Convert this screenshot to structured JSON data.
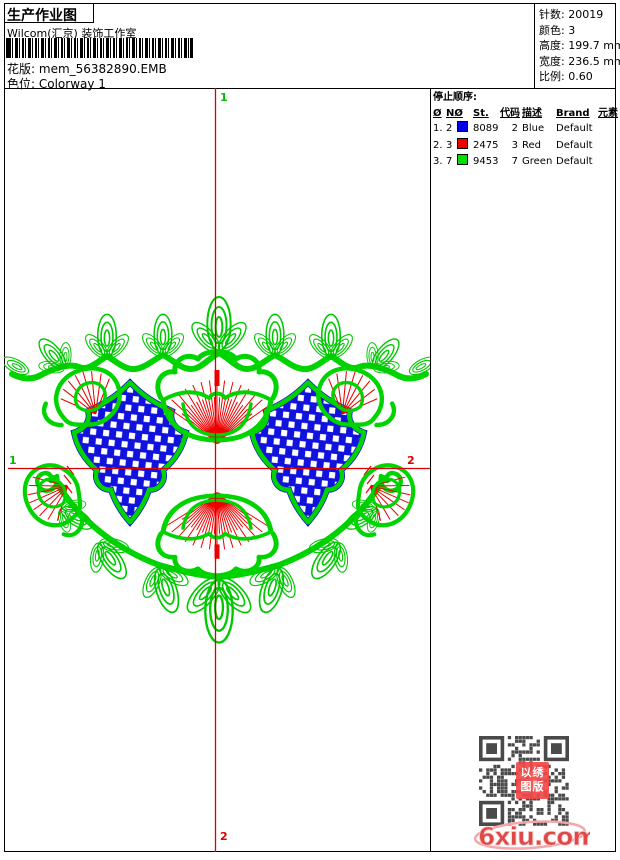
{
  "header": {
    "title": "生产作业图",
    "studio": "Wilcom(汇京) 装饰工作室",
    "pattern_label": "花版:",
    "pattern_value": "mem_56382890.EMB",
    "colorway_label": "色位:",
    "colorway_value": "Colorway 1"
  },
  "info": {
    "stitches_label": "针数:",
    "stitches_value": "20019",
    "colors_label": "颜色:",
    "colors_value": "3",
    "height_label": "高度:",
    "height_value": "199.7 mm",
    "width_label": "宽度:",
    "width_value": "236.5 mm",
    "scale_label": "比例:",
    "scale_value": "0.60"
  },
  "stop_sequence": {
    "title": "停止顺序:",
    "columns": {
      "c0": "Ø",
      "c1": "NØ",
      "c2": "",
      "c3": "St.",
      "c4": "代码",
      "c5": "描述",
      "c6": "Brand",
      "c7": "元素"
    },
    "rows": [
      {
        "no": "1.",
        "n": "2",
        "color": "#0000ee",
        "st": "8089",
        "code": "2",
        "desc": "Blue",
        "brand": "Default",
        "elem": ""
      },
      {
        "no": "2.",
        "n": "3",
        "color": "#ee0000",
        "st": "2475",
        "code": "3",
        "desc": "Red",
        "brand": "Default",
        "elem": ""
      },
      {
        "no": "3.",
        "n": "7",
        "color": "#00dd00",
        "st": "9453",
        "code": "7",
        "desc": "Green",
        "brand": "Default",
        "elem": ""
      }
    ]
  },
  "canvas": {
    "markers": {
      "top": "1",
      "left": "1",
      "right": "2",
      "bottom": "2"
    },
    "colors": {
      "green": "#00d400",
      "leaf_green": "#00c800",
      "blue": "#1212dd",
      "red": "#ee0000",
      "crosshair": "#dd0000",
      "marker_green": "#00bb00",
      "marker_red": "#dd0000"
    }
  },
  "watermark": {
    "stamp_line1": "以绣",
    "stamp_line2": "图版",
    "logo": "6xiu.com"
  }
}
